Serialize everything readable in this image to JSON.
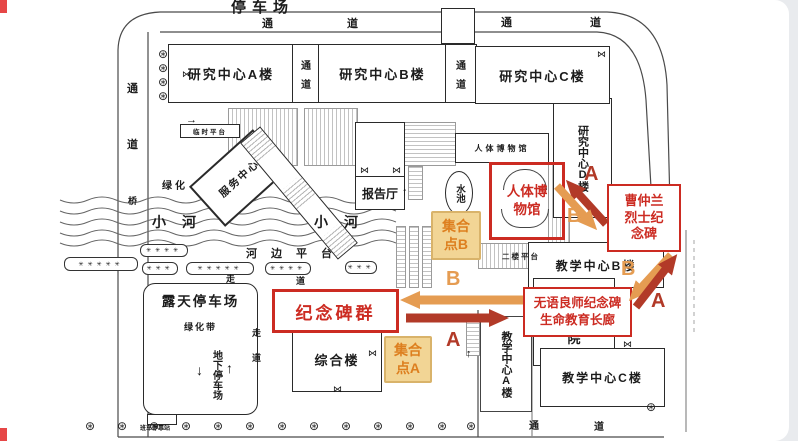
{
  "colors": {
    "routeA": "#b23a28",
    "routeB": "#e59c52",
    "redAnno": "#cc2b22",
    "assemblyBg": "#f2d595",
    "assemblyBorder": "#d9b36a",
    "assemblyText": "#dd7f1f",
    "accentRed": "#e64747",
    "ink": "#1c1c1c"
  },
  "top": {
    "parking_title": "停车场"
  },
  "roads": {
    "tong": "通",
    "dao": "道",
    "zou": "走"
  },
  "buildings": {
    "research_a": "研究中心A楼",
    "research_b": "研究中心B楼",
    "research_c": "研究中心C楼",
    "research_d": "研究中心D楼",
    "museum_building": "人体博物馆",
    "lecture_hall": "报告厅",
    "service_center": "服务中心",
    "composite": "综合楼",
    "teaching_a": "教学中心A楼",
    "teaching_b": "教学中心B楼",
    "teaching_c": "教学中心C楼",
    "yuan": "院"
  },
  "areas": {
    "green": "绿化",
    "green_belt": "绿化带",
    "river": "小河",
    "riverside_platform": "河边平台",
    "bridge": "桥",
    "temp_platform": "临时平台",
    "second_floor_platform": "二楼平台",
    "open_parking": "露天停车场",
    "underground_parking": "地下停车场",
    "pool": "水池",
    "shuttle_stop": "班车停靠站"
  },
  "annotations": {
    "monument_group": "纪念碑群",
    "museum": "人体博物馆",
    "martyr_monument": "曹仲兰烈士纪念碑",
    "silent_mentor_line1": "无语良师纪念碑",
    "silent_mentor_line2": "生命教育长廊",
    "assembly_a": "集合点A",
    "assembly_b": "集合点B",
    "route_a": "A",
    "route_b": "B"
  },
  "icons": {
    "tree": "⊛",
    "door": "⋈",
    "arrow_up": "↑",
    "arrow_down": "↓",
    "arrow_right": "→",
    "dots3": "✳✳✳",
    "dots4": "✳✳✳✳",
    "dots5": "✳✳✳✳✳"
  }
}
